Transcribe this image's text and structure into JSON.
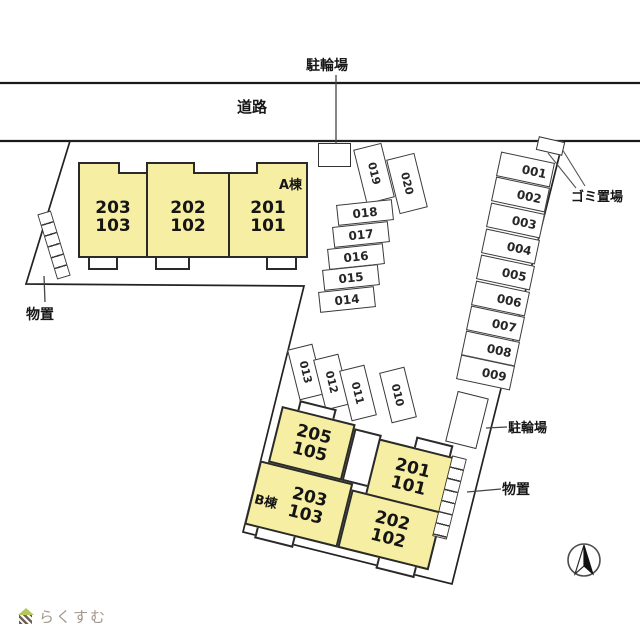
{
  "labels": {
    "road": "道路",
    "bicycle_top": "駐輪場",
    "garbage": "ゴミ置場",
    "storage_left": "物置",
    "bicycle_lower": "駐輪場",
    "storage_right": "物置"
  },
  "building_a": {
    "name": "A棟",
    "units": [
      {
        "upper": "203",
        "lower": "103"
      },
      {
        "upper": "202",
        "lower": "102"
      },
      {
        "upper": "201",
        "lower": "101"
      }
    ]
  },
  "building_b": {
    "name": "B棟",
    "units": [
      {
        "upper": "205",
        "lower": "105"
      },
      {
        "upper": "201",
        "lower": "101"
      },
      {
        "upper": "203",
        "lower": "103"
      },
      {
        "upper": "202",
        "lower": "102"
      }
    ]
  },
  "parking": {
    "right": [
      "001",
      "002",
      "003",
      "004",
      "005",
      "006",
      "007",
      "008",
      "009"
    ],
    "middle": [
      "018",
      "017",
      "016",
      "015",
      "014"
    ],
    "pair": [
      "019",
      "020"
    ],
    "trio": [
      "013",
      "012",
      "011"
    ],
    "single": [
      "010"
    ]
  },
  "compass": {
    "meaning": "north-arrow"
  },
  "logo": {
    "text": "らくすむ"
  },
  "colors": {
    "unit_fill": "#f6efa3",
    "line": "#2a2a2a"
  }
}
